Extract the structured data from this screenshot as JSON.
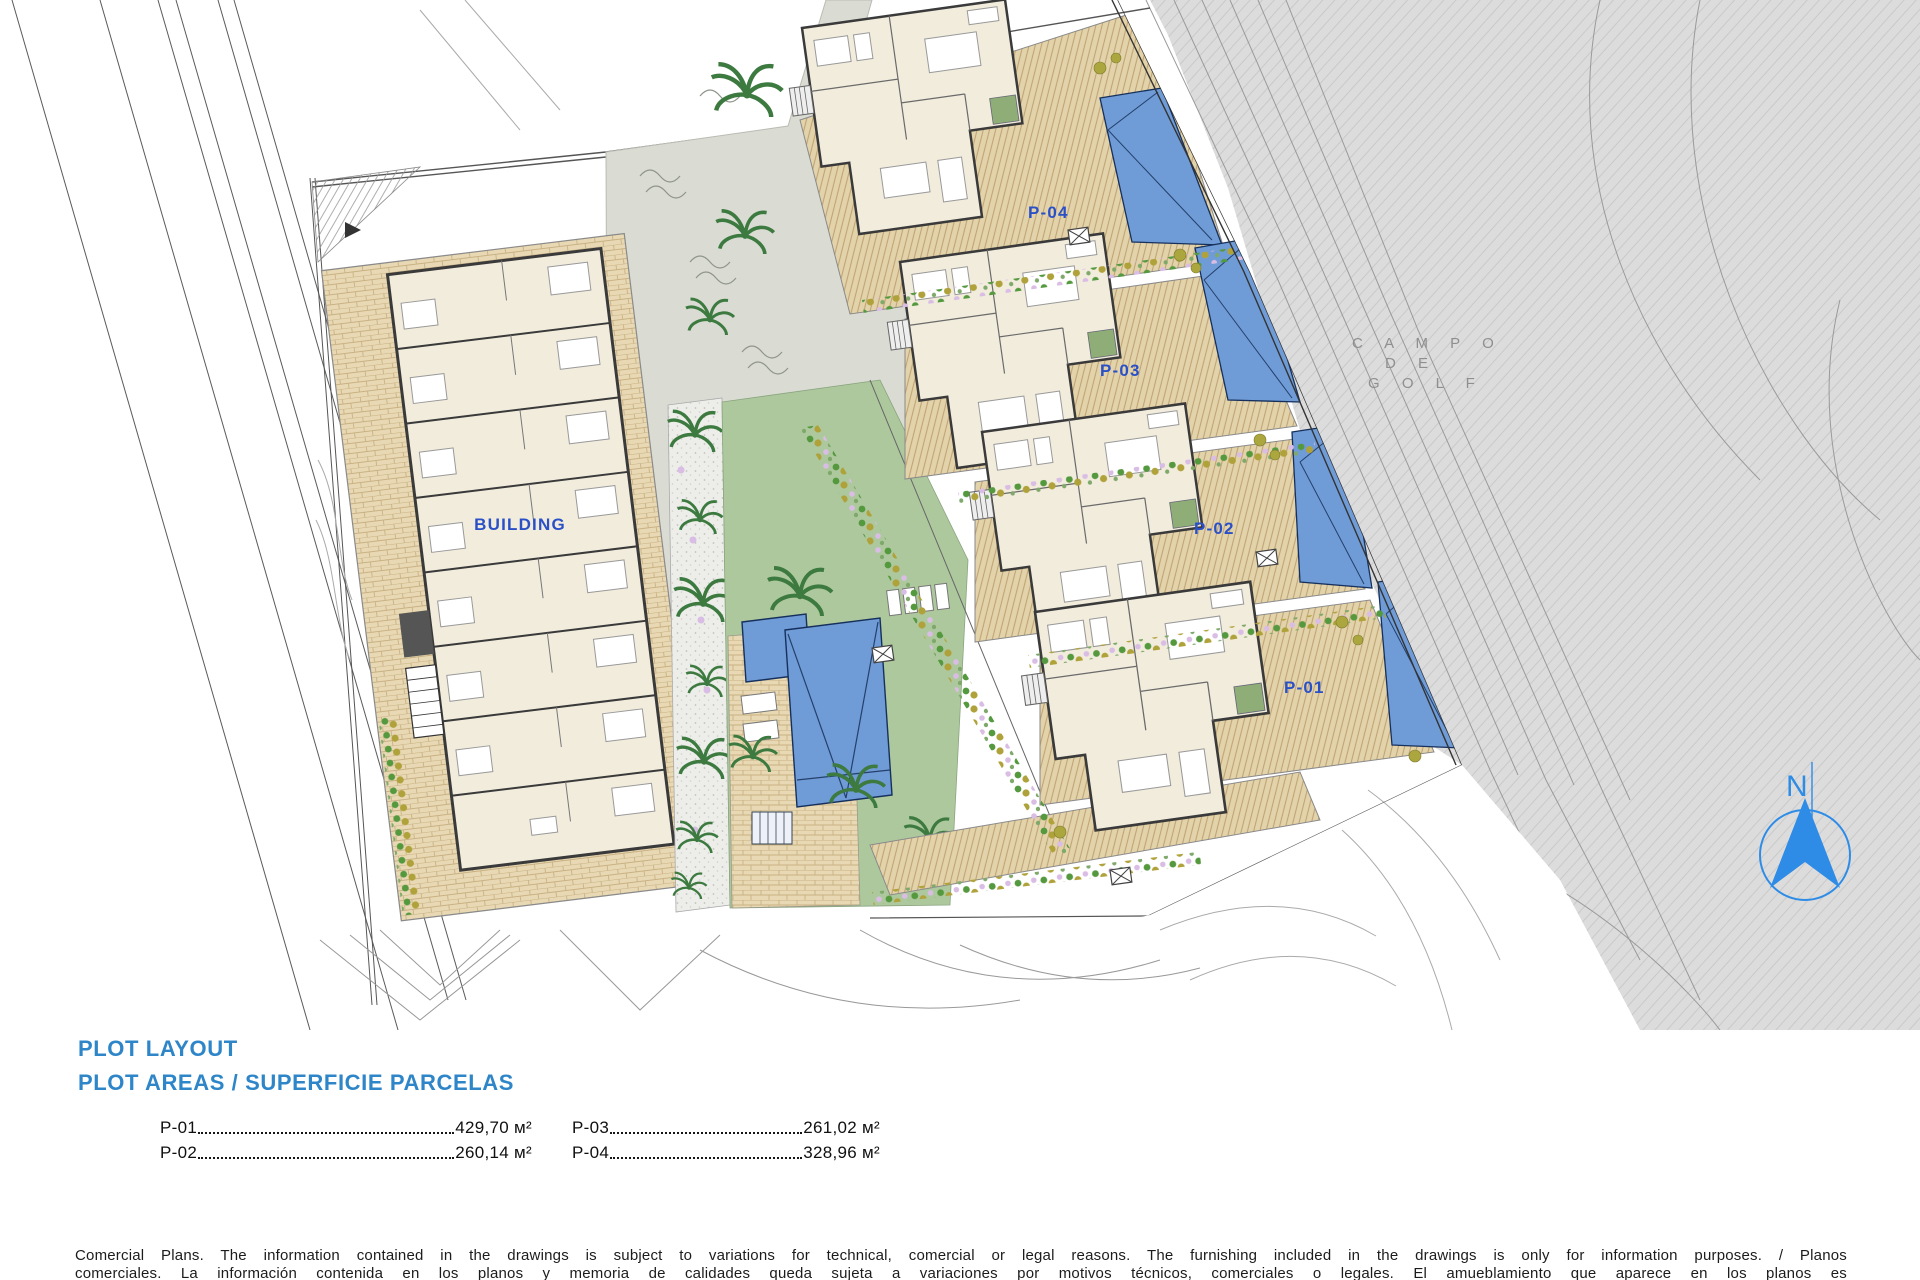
{
  "plan": {
    "building_label": "BUILDING",
    "plots": [
      {
        "label": "P-04"
      },
      {
        "label": "P-03"
      },
      {
        "label": "P-02"
      },
      {
        "label": "P-01"
      }
    ],
    "golf_label": [
      "C A M P O",
      "D E",
      "G O L F"
    ],
    "compass": "N"
  },
  "legend": {
    "title_line1": "PLOT LAYOUT",
    "title_line2": "PLOT AREAS / SUPERFICIE PARCELAS",
    "areas": [
      {
        "plot": "P-01",
        "value": "429,70 м²"
      },
      {
        "plot": "P-02",
        "value": "260,14 м²"
      },
      {
        "plot": "P-03",
        "value": "261,02 м²"
      },
      {
        "plot": "P-04",
        "value": "328,96 м²"
      }
    ]
  },
  "disclaimer": "Comercial Plans. The information contained in the drawings is subject to variations for technical, comercial or legal reasons. The furnishing included in the drawings is only for information purposes. / Planos comerciales. La información contenida en los planos y memoria de calidades queda sujeta a variaciones por motivos técnicos, comerciales o legales. El amueblamiento que aparece en los planos es meramente informativo.",
  "colors": {
    "heading_blue": "#2e86c9",
    "plan_label_blue": "#2a50c8",
    "pool_blue": "#6f9bd6",
    "terrace_tan": "#e6d7b2",
    "grass_green": "#aec89e",
    "golf_gray": "#dcdcdc",
    "compass_blue": "#2e8ce6"
  }
}
